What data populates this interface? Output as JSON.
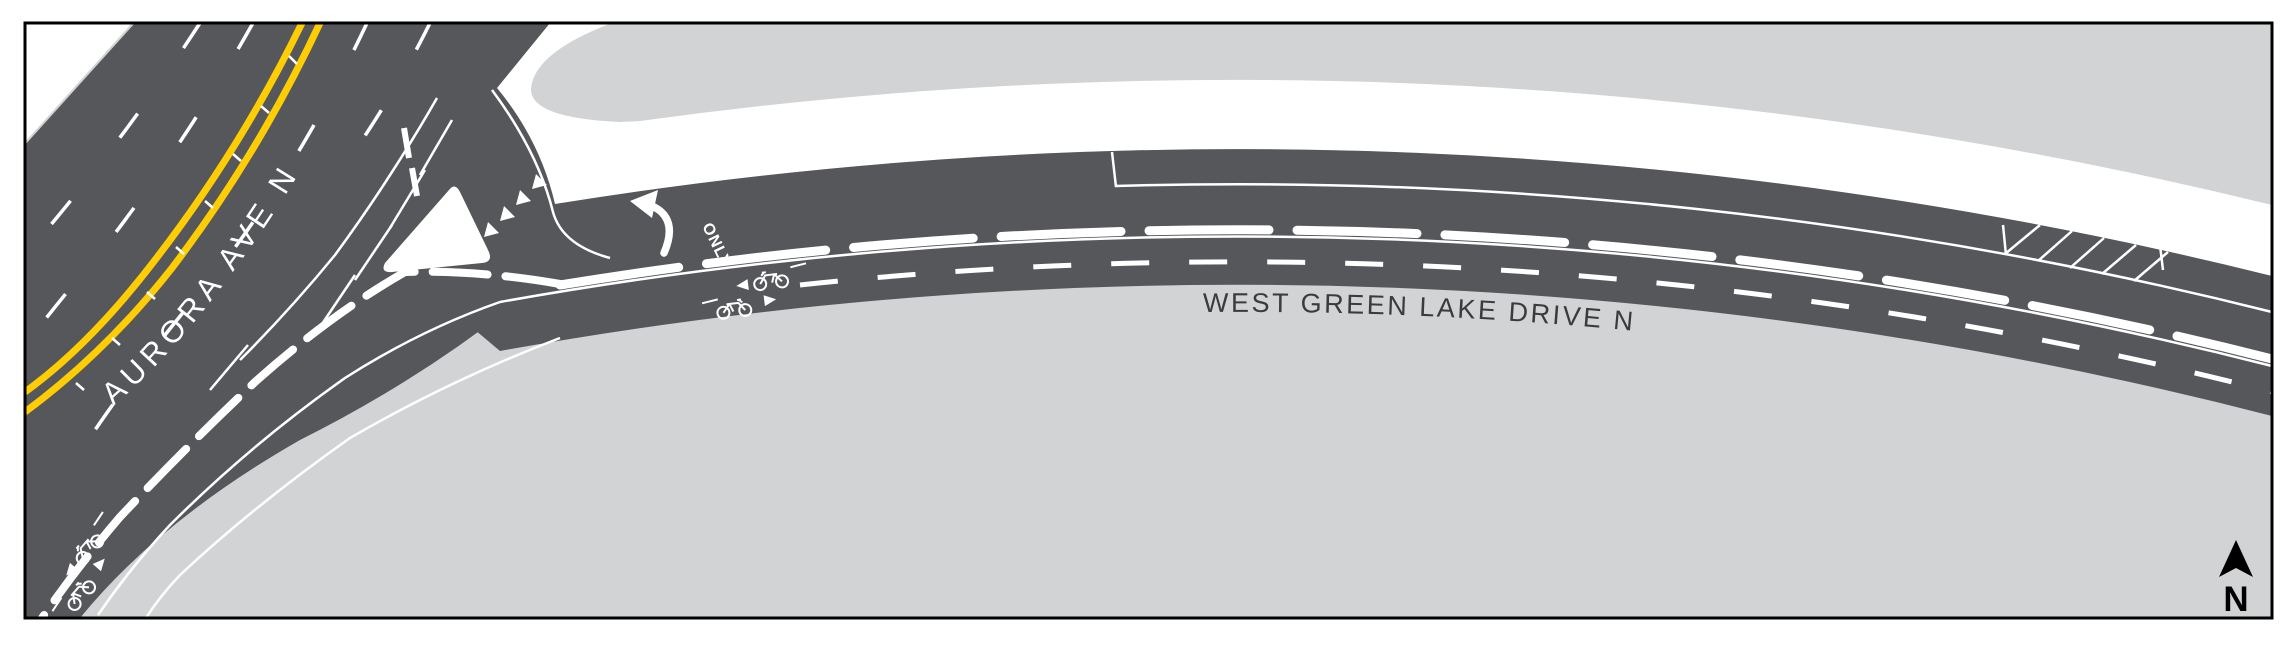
{
  "map": {
    "title": "Aurora Ave N / West Green Lake Drive N channelization plan",
    "labels": {
      "aurora_ave": "AURORA AVE N",
      "west_green_lake_drive": "WEST GREEN LAKE DRIVE N",
      "only_marking": "ONLY",
      "north": "N"
    },
    "colors": {
      "road": "#56575B",
      "background": "#D2D3D5",
      "path_white": "#FFFFFF",
      "centerline_yellow": "#FFCD03",
      "marking_white": "#FFFFFF",
      "street_label_dark": "#3A3B3D",
      "frame_black": "#000000"
    }
  }
}
